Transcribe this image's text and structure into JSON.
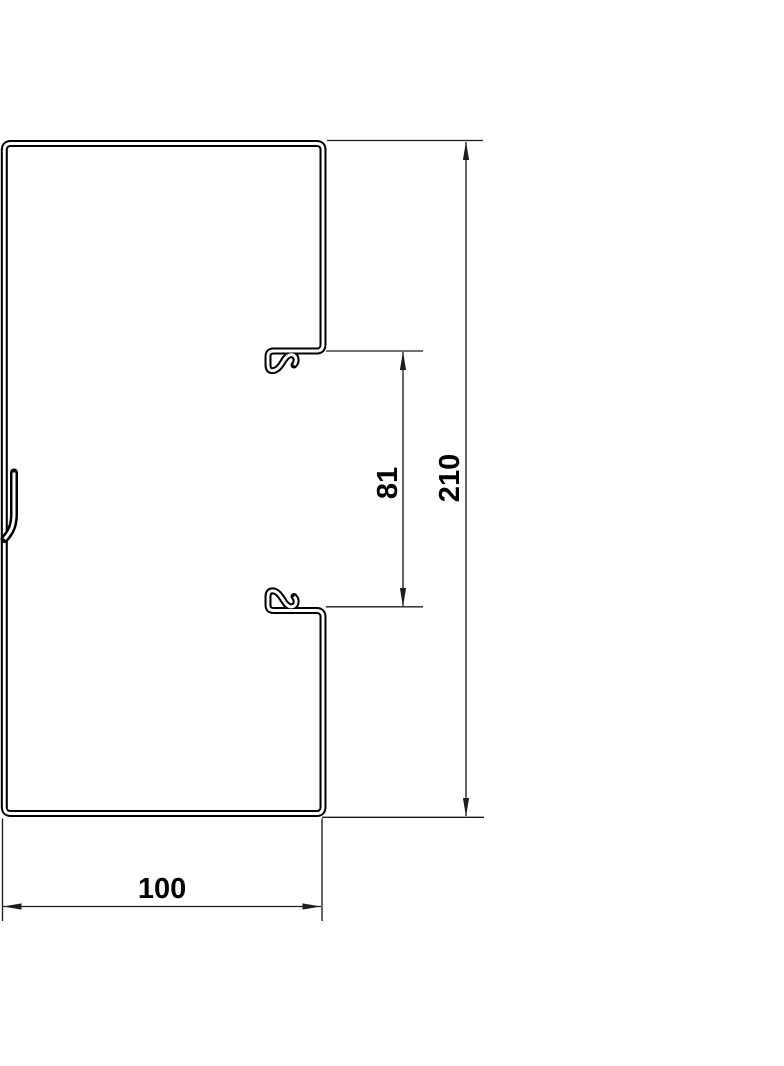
{
  "drawing": {
    "name": "cable-trunking-profile-cross-section",
    "background": "#ffffff",
    "profile_line_color": "#000000",
    "dimension_line_color": "#1c1c1c",
    "text_color": "#000000",
    "dimensions": {
      "outer_width": {
        "value": "100",
        "orientation": "horizontal"
      },
      "outer_height": {
        "value": "210",
        "orientation": "vertical"
      },
      "opening_height": {
        "value": "81",
        "orientation": "vertical"
      }
    }
  }
}
